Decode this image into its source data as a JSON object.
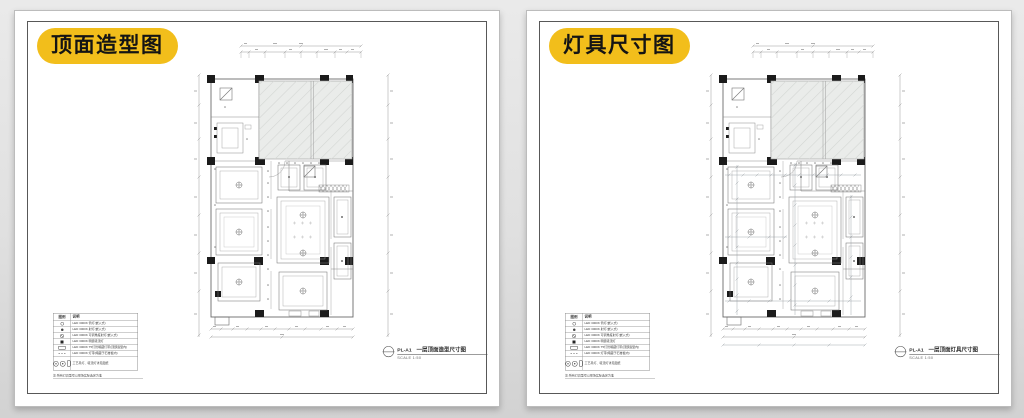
{
  "page": {
    "background_top": "#eaeaea",
    "background_bottom": "#d2d2d2"
  },
  "colors": {
    "badge": "#F2BE1B",
    "frame": "#585858",
    "hatch_panel": "#eaecea",
    "wall": "#6a6a6a"
  },
  "sheets": {
    "left": {
      "badge": "顶面造型图",
      "code": "PL-A1",
      "title": "一层顶面造型尺寸图",
      "scale": "SCALE  1:50"
    },
    "right": {
      "badge": "灯具尺寸图",
      "code": "PL-A1",
      "title": "一层顶面灯具尺寸图",
      "scale": "SCALE  1:50"
    }
  },
  "legend": {
    "header_symbol": "图例",
    "header_desc": "说明",
    "rows": [
      {
        "symbol": "downlight-icon",
        "desc": "LED 3000K 筒灯(嵌入式)"
      },
      {
        "symbol": "spotlight-icon",
        "desc": "LED 3000K 射灯(嵌入式)"
      },
      {
        "symbol": "adjustable-spot-icon",
        "desc": "LED 3000K 可调角度射灯(嵌入式)"
      },
      {
        "symbol": "ceiling-lamp-icon",
        "desc": "LED 3000K 明装吸顶灯"
      },
      {
        "symbol": "light-strip-icon",
        "desc": "LED 3000K T5灯管暗藏灯带(顶部造型内)"
      },
      {
        "symbol": "cove-light-icon",
        "desc": "LED 3000K 灯带(暗藏于石膏板内)"
      },
      {
        "symbol": "pendant-group-icon",
        "desc": "工艺吊灯、吸顶灯详见图纸"
      }
    ],
    "note": "注:所有灯具型号以现场实际选定为准"
  }
}
